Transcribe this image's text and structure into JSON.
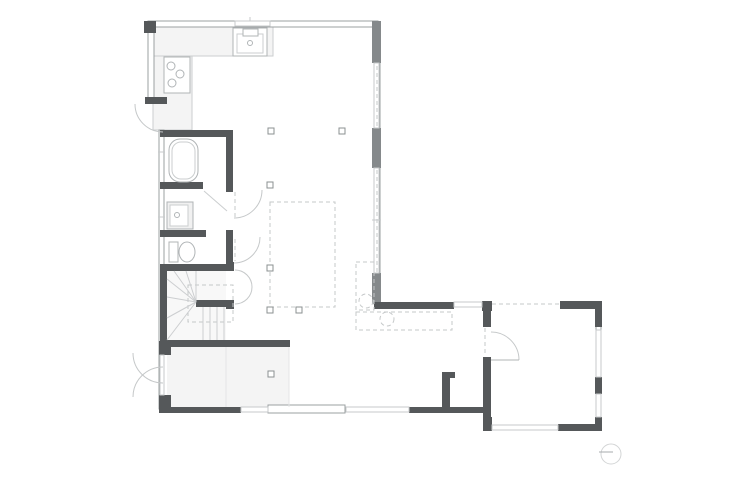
{
  "meta": {
    "width": 750,
    "height": 489,
    "background": "#ffffff",
    "drawing": "floor-plan"
  },
  "palette": {
    "wall": "#9ba0a2",
    "dark": "#55585a",
    "pier": "#85898b",
    "win": "#c7cacb",
    "fix": "#b0b4b6",
    "fixlight": "#cbcecf",
    "dash": "#c5c8c9",
    "floor": "#f4f4f4",
    "stair": "#ccced0",
    "faint": "#e4e5e6",
    "sym": "#d3d5d6",
    "symline": "#a7abad"
  },
  "shapes": [
    {
      "t": "rect",
      "n": "entry-floor",
      "x": 167,
      "y": 347,
      "w": 122,
      "h": 60,
      "f": "floor"
    },
    {
      "t": "rect",
      "n": "stair-floor",
      "x": 167,
      "y": 271,
      "w": 59,
      "h": 69,
      "f": "#f8f8f8"
    },
    {
      "t": "rect",
      "n": "kitchen-counter-left",
      "x": 153,
      "y": 27,
      "w": 39,
      "h": 103,
      "f": "floor",
      "st": "fixlight"
    },
    {
      "t": "rect",
      "n": "kitchen-counter-top",
      "x": 153,
      "y": 27,
      "w": 120,
      "h": 29,
      "f": "floor",
      "st": "fixlight"
    },
    {
      "t": "rect",
      "n": "exterior-wall-top",
      "x": 148,
      "y": 21,
      "w": 230,
      "h": 6,
      "f": "#ffffff",
      "st": "wall"
    },
    {
      "t": "rect",
      "n": "exterior-wall-left-upper",
      "x": 148,
      "y": 21,
      "w": 6,
      "h": 77,
      "f": "#ffffff",
      "st": "wall"
    },
    {
      "t": "rect",
      "n": "exterior-wall-right",
      "x": 374,
      "y": 27,
      "w": 6,
      "h": 277,
      "f": "#ffffff",
      "st": "wall"
    },
    {
      "t": "rect",
      "n": "exterior-wall-left-mid",
      "x": 159,
      "y": 130,
      "w": 5,
      "h": 217,
      "f": "#ffffff",
      "st": "wall"
    },
    {
      "t": "rect",
      "n": "exterior-wall-left-entry",
      "x": 159,
      "y": 347,
      "w": 5,
      "h": 62,
      "f": "#ffffff",
      "st": "wall"
    },
    {
      "t": "rect",
      "n": "room-wall-right",
      "x": 596,
      "y": 308,
      "w": 5,
      "h": 117,
      "f": "#ffffff",
      "st": "wall"
    },
    {
      "t": "rect",
      "n": "sliding-door-panel",
      "x": 268,
      "y": 405,
      "w": 77,
      "h": 8,
      "f": "#ffffff",
      "st": "wall"
    },
    {
      "t": "rect",
      "n": "corner-pier",
      "x": 144,
      "y": 21,
      "w": 12,
      "h": 12,
      "f": "dark"
    },
    {
      "t": "rect",
      "n": "wall-pier",
      "x": 372,
      "y": 21,
      "w": 9,
      "h": 42,
      "f": "pier"
    },
    {
      "t": "rect",
      "n": "wall-pier",
      "x": 372,
      "y": 128,
      "w": 9,
      "h": 40,
      "f": "pier"
    },
    {
      "t": "rect",
      "n": "wall-pier",
      "x": 372,
      "y": 273,
      "w": 9,
      "h": 31,
      "f": "pier"
    },
    {
      "t": "rect",
      "n": "kitchen-door-cap",
      "x": 145,
      "y": 97,
      "w": 22,
      "h": 7,
      "f": "dark"
    },
    {
      "t": "rect",
      "n": "entry-pier-top",
      "x": 159,
      "y": 341,
      "w": 12,
      "h": 14,
      "f": "dark"
    },
    {
      "t": "rect",
      "n": "entry-pier-bottom",
      "x": 159,
      "y": 395,
      "w": 12,
      "h": 16,
      "f": "dark"
    },
    {
      "t": "rect",
      "n": "wing-wall-top",
      "x": 374,
      "y": 302,
      "w": 80,
      "h": 7,
      "f": "dark"
    },
    {
      "t": "rect",
      "n": "wall-pier",
      "x": 482,
      "y": 301,
      "w": 10,
      "h": 10,
      "f": "dark"
    },
    {
      "t": "rect",
      "n": "room-wall-left-upper",
      "x": 483,
      "y": 309,
      "w": 8,
      "h": 18,
      "f": "dark"
    },
    {
      "t": "rect",
      "n": "room-wall-left-lower",
      "x": 483,
      "y": 357,
      "w": 8,
      "h": 74,
      "f": "dark"
    },
    {
      "t": "rect",
      "n": "room-wall-top",
      "x": 560,
      "y": 301,
      "w": 42,
      "h": 8,
      "f": "dark"
    },
    {
      "t": "rect",
      "n": "room-pier-ne",
      "x": 595,
      "y": 301,
      "w": 7,
      "h": 26,
      "f": "dark"
    },
    {
      "t": "rect",
      "n": "room-pier-east",
      "x": 595,
      "y": 377,
      "w": 7,
      "h": 17,
      "f": "dark"
    },
    {
      "t": "rect",
      "n": "room-pier-se",
      "x": 595,
      "y": 417,
      "w": 7,
      "h": 14,
      "f": "dark"
    },
    {
      "t": "rect",
      "n": "room-wall-bottom",
      "x": 558,
      "y": 424,
      "w": 44,
      "h": 7,
      "f": "dark"
    },
    {
      "t": "rect",
      "n": "room-pier-sw",
      "x": 483,
      "y": 417,
      "w": 9,
      "h": 14,
      "f": "dark"
    },
    {
      "t": "rect",
      "n": "wall-bottom-a",
      "x": 159,
      "y": 407,
      "w": 82,
      "h": 6,
      "f": "dark"
    },
    {
      "t": "rect",
      "n": "wall-bottom-b",
      "x": 409,
      "y": 407,
      "w": 77,
      "h": 6,
      "f": "dark"
    },
    {
      "t": "rect",
      "n": "wall-stub",
      "x": 442,
      "y": 372,
      "w": 8,
      "h": 41,
      "f": "dark"
    },
    {
      "t": "rect",
      "n": "wall-stub-notch",
      "x": 450,
      "y": 372,
      "w": 5,
      "h": 6,
      "f": "dark"
    },
    {
      "t": "rect",
      "n": "bath-wall-top",
      "x": 160,
      "y": 130,
      "w": 73,
      "h": 7,
      "f": "dark"
    },
    {
      "t": "rect",
      "n": "bath-wall-right",
      "x": 226,
      "y": 130,
      "w": 7,
      "h": 62,
      "f": "dark"
    },
    {
      "t": "rect",
      "n": "bath-wall-low",
      "x": 160,
      "y": 182,
      "w": 43,
      "h": 7,
      "f": "dark"
    },
    {
      "t": "rect",
      "n": "washroom-toilet-wall",
      "x": 160,
      "y": 230,
      "w": 46,
      "h": 7,
      "f": "dark"
    },
    {
      "t": "rect",
      "n": "toilet-wall-right",
      "x": 226,
      "y": 230,
      "w": 7,
      "h": 40,
      "f": "dark"
    },
    {
      "t": "rect",
      "n": "stair-wall-top",
      "x": 160,
      "y": 264,
      "w": 73,
      "h": 7,
      "f": "dark"
    },
    {
      "t": "rect",
      "n": "stair-wall-left",
      "x": 160,
      "y": 264,
      "w": 7,
      "h": 83,
      "f": "dark"
    },
    {
      "t": "rect",
      "n": "closet-pier-top",
      "x": 226,
      "y": 262,
      "w": 8,
      "h": 9,
      "f": "dark"
    },
    {
      "t": "rect",
      "n": "closet-pier-bottom",
      "x": 226,
      "y": 300,
      "w": 8,
      "h": 9,
      "f": "dark"
    },
    {
      "t": "rect",
      "n": "stair-landing-wall",
      "x": 196,
      "y": 300,
      "w": 37,
      "h": 7,
      "f": "dark"
    },
    {
      "t": "rect",
      "n": "stair-wall-bottom",
      "x": 160,
      "y": 340,
      "w": 130,
      "h": 7,
      "f": "dark"
    },
    {
      "t": "rect",
      "n": "window",
      "x": 235,
      "y": 21,
      "w": 35,
      "h": 5,
      "f": "#ffffff",
      "st": "win"
    },
    {
      "t": "rect",
      "n": "window",
      "x": 374,
      "y": 63,
      "w": 5,
      "h": 65,
      "f": "#ffffff",
      "st": "win"
    },
    {
      "t": "rect",
      "n": "window",
      "x": 374,
      "y": 168,
      "w": 5,
      "h": 105,
      "f": "#ffffff",
      "st": "win"
    },
    {
      "t": "rect",
      "n": "window",
      "x": 241,
      "y": 407,
      "w": 27,
      "h": 5,
      "f": "#ffffff",
      "st": "win"
    },
    {
      "t": "rect",
      "n": "window",
      "x": 346,
      "y": 407,
      "w": 63,
      "h": 5,
      "f": "#ffffff",
      "st": "win"
    },
    {
      "t": "rect",
      "n": "window",
      "x": 454,
      "y": 302,
      "w": 28,
      "h": 5,
      "f": "#ffffff",
      "st": "win"
    },
    {
      "t": "rect",
      "n": "window",
      "x": 596,
      "y": 330,
      "w": 5,
      "h": 47,
      "f": "#ffffff",
      "st": "win"
    },
    {
      "t": "rect",
      "n": "window",
      "x": 596,
      "y": 394,
      "w": 5,
      "h": 23,
      "f": "#ffffff",
      "st": "win"
    },
    {
      "t": "rect",
      "n": "window",
      "x": 492,
      "y": 425,
      "w": 66,
      "h": 5,
      "f": "#ffffff",
      "st": "win"
    },
    {
      "t": "rect",
      "n": "window",
      "x": 160,
      "y": 355,
      "w": 4,
      "h": 40,
      "f": "#ffffff",
      "st": "win"
    },
    {
      "t": "line",
      "n": "window-glazing-dash",
      "x1": 377,
      "y1": 66,
      "x2": 377,
      "y2": 127,
      "st": "dash",
      "d": true
    },
    {
      "t": "line",
      "n": "window-glazing-dash",
      "x1": 377,
      "y1": 170,
      "x2": 377,
      "y2": 272,
      "st": "dash",
      "d": true
    },
    {
      "t": "line",
      "n": "room-top-opening-dash",
      "x1": 492,
      "y1": 304,
      "x2": 559,
      "y2": 304,
      "st": "dash",
      "d": true
    },
    {
      "t": "line",
      "n": "room-door-opening-dash",
      "x1": 485,
      "y1": 328,
      "x2": 485,
      "y2": 356,
      "st": "dash",
      "d": true
    },
    {
      "t": "line",
      "n": "washroom-door-dash",
      "x1": 235,
      "y1": 192,
      "x2": 235,
      "y2": 217,
      "st": "dash",
      "d": true
    },
    {
      "t": "line",
      "n": "toilet-door-dash",
      "x1": 235,
      "y1": 239,
      "x2": 235,
      "y2": 261,
      "st": "dash",
      "d": true
    },
    {
      "t": "rect",
      "n": "void-outline-dashed",
      "x": 270,
      "y": 202,
      "w": 65,
      "h": 105,
      "st": "dash",
      "d": true
    },
    {
      "t": "rect",
      "n": "dashed-counter-side",
      "x": 356,
      "y": 262,
      "w": 18,
      "h": 48,
      "st": "dash",
      "d": true
    },
    {
      "t": "rect",
      "n": "dashed-counter-bottom",
      "x": 356,
      "y": 312,
      "w": 96,
      "h": 18,
      "st": "dash",
      "d": true
    },
    {
      "t": "rect",
      "n": "stair-overhead-dashed",
      "x": 188,
      "y": 285,
      "w": 45,
      "h": 37,
      "st": "dash",
      "d": true
    },
    {
      "t": "circle",
      "n": "dashed-fixture-circle",
      "cx": 366,
      "cy": 301,
      "r": 7,
      "st": "dash",
      "d": true
    },
    {
      "t": "circle",
      "n": "dashed-fixture-circle",
      "cx": 387,
      "cy": 319,
      "r": 7,
      "st": "dash",
      "d": true
    },
    {
      "t": "sq",
      "n": "column-marker",
      "cx": 271,
      "cy": 131,
      "s": 6
    },
    {
      "t": "sq",
      "n": "column-marker",
      "cx": 342,
      "cy": 131,
      "s": 6
    },
    {
      "t": "sq",
      "n": "column-marker",
      "cx": 270,
      "cy": 185,
      "s": 6
    },
    {
      "t": "sq",
      "n": "column-marker",
      "cx": 270,
      "cy": 268,
      "s": 6
    },
    {
      "t": "sq",
      "n": "column-marker",
      "cx": 270,
      "cy": 310,
      "s": 6
    },
    {
      "t": "sq",
      "n": "column-marker",
      "cx": 299,
      "cy": 310,
      "s": 6
    },
    {
      "t": "sq",
      "n": "column-marker",
      "cx": 271,
      "cy": 374,
      "s": 6
    },
    {
      "t": "rect",
      "n": "cooktop",
      "x": 164,
      "y": 57,
      "w": 26,
      "h": 36,
      "f": "#ffffff",
      "st": "fix"
    },
    {
      "t": "circle",
      "n": "burner",
      "cx": 171,
      "cy": 66,
      "r": 4,
      "st": "fix"
    },
    {
      "t": "circle",
      "n": "burner",
      "cx": 180,
      "cy": 74,
      "r": 4,
      "st": "fix"
    },
    {
      "t": "circle",
      "n": "burner",
      "cx": 172,
      "cy": 83,
      "r": 4,
      "st": "fix"
    },
    {
      "t": "rect",
      "n": "kitchen-sink",
      "x": 233,
      "y": 28,
      "w": 34,
      "h": 28,
      "f": "#ffffff",
      "st": "fix"
    },
    {
      "t": "rect",
      "n": "kitchen-sink-basin",
      "x": 237,
      "y": 34,
      "w": 26,
      "h": 19,
      "st": "fixlight"
    },
    {
      "t": "rect",
      "n": "kitchen-faucet",
      "x": 243,
      "y": 29,
      "w": 15,
      "h": 7,
      "f": "#ffffff",
      "st": "fix"
    },
    {
      "t": "circle",
      "n": "sink-drain",
      "cx": 250,
      "cy": 43,
      "r": 2.5,
      "st": "fix"
    },
    {
      "t": "rect",
      "n": "bathtub",
      "x": 169,
      "y": 139,
      "w": 29,
      "h": 43,
      "rx": 11,
      "f": "#ffffff",
      "st": "fix"
    },
    {
      "t": "rect",
      "n": "bathtub-inner",
      "x": 172,
      "y": 142,
      "w": 23,
      "h": 37,
      "rx": 9,
      "st": "fixlight"
    },
    {
      "t": "rect",
      "n": "washbasin",
      "x": 167,
      "y": 202,
      "w": 26,
      "h": 27,
      "f": "#f1f1f1",
      "st": "fix"
    },
    {
      "t": "rect",
      "n": "washbasin-bowl",
      "x": 170,
      "y": 205,
      "w": 18,
      "h": 21,
      "f": "#ffffff",
      "st": "fixlight"
    },
    {
      "t": "circle",
      "n": "washbasin-drain",
      "cx": 177,
      "cy": 215,
      "r": 2.5,
      "st": "fix"
    },
    {
      "t": "rect",
      "n": "toilet-tank",
      "x": 169,
      "y": 242,
      "w": 9,
      "h": 20,
      "f": "#ffffff",
      "st": "fix"
    },
    {
      "t": "ellipse",
      "n": "toilet-bowl",
      "cx": 187,
      "cy": 252,
      "rx": 8,
      "ry": 10,
      "f": "#ffffff",
      "st": "fix"
    },
    {
      "t": "line",
      "n": "stair-winder",
      "x1": 196,
      "y1": 302,
      "x2": 167,
      "y2": 340,
      "st": "stair"
    },
    {
      "t": "line",
      "n": "stair-winder",
      "x1": 196,
      "y1": 302,
      "x2": 167,
      "y2": 318,
      "st": "stair"
    },
    {
      "t": "line",
      "n": "stair-winder",
      "x1": 196,
      "y1": 302,
      "x2": 167,
      "y2": 297,
      "st": "stair"
    },
    {
      "t": "line",
      "n": "stair-winder",
      "x1": 196,
      "y1": 302,
      "x2": 167,
      "y2": 279,
      "st": "stair"
    },
    {
      "t": "line",
      "n": "stair-winder",
      "x1": 196,
      "y1": 302,
      "x2": 174,
      "y2": 271,
      "st": "stair"
    },
    {
      "t": "line",
      "n": "stair-winder",
      "x1": 196,
      "y1": 302,
      "x2": 186,
      "y2": 271,
      "st": "stair"
    },
    {
      "t": "line",
      "n": "stair-winder",
      "x1": 196,
      "y1": 302,
      "x2": 196,
      "y2": 271,
      "st": "stair"
    },
    {
      "t": "line",
      "n": "stair-tread",
      "x1": 203,
      "y1": 307,
      "x2": 203,
      "y2": 340,
      "st": "stair"
    },
    {
      "t": "line",
      "n": "stair-tread",
      "x1": 210,
      "y1": 307,
      "x2": 210,
      "y2": 340,
      "st": "stair"
    },
    {
      "t": "line",
      "n": "stair-tread",
      "x1": 217,
      "y1": 307,
      "x2": 217,
      "y2": 340,
      "st": "stair"
    },
    {
      "t": "line",
      "n": "stair-tread",
      "x1": 224,
      "y1": 307,
      "x2": 224,
      "y2": 340,
      "st": "stair"
    },
    {
      "t": "path",
      "n": "kitchen-door-arc",
      "p": "M163,132 A28,28 0 0 1 135,104",
      "st": "dash"
    },
    {
      "t": "path",
      "n": "entry-door-arc",
      "p": "M163,383 A30,30 0 0 1 133,353",
      "st": "dash"
    },
    {
      "t": "path",
      "n": "entry-door-arc",
      "p": "M163,367 A30,30 0 0 0 133,397",
      "st": "dash"
    },
    {
      "t": "path",
      "n": "washroom-door-arc",
      "p": "M234,218 A28,28 0 0 0 262,190",
      "st": "dash"
    },
    {
      "t": "path",
      "n": "toilet-door-arc",
      "p": "M234,263 A26,26 0 0 0 260,237",
      "st": "dash"
    },
    {
      "t": "path",
      "n": "closet-door-arc",
      "p": "M235,270 A17,17 0 0 1 252,287",
      "st": "dash"
    },
    {
      "t": "path",
      "n": "closet-door-arc",
      "p": "M235,304 A17,17 0 0 0 252,287",
      "st": "dash"
    },
    {
      "t": "path",
      "n": "room-door-arc",
      "p": "M491,332 A28,28 0 0 1 519,360",
      "st": "dash"
    },
    {
      "t": "line",
      "n": "room-door-leaf",
      "x1": 491,
      "y1": 360,
      "x2": 519,
      "y2": 360,
      "st": "fix"
    },
    {
      "t": "line",
      "n": "bath-door-line",
      "x1": 204,
      "y1": 191,
      "x2": 227,
      "y2": 211,
      "st": "fixlight"
    },
    {
      "t": "line",
      "n": "entry-floor-edge",
      "x1": 226,
      "y1": 347,
      "x2": 226,
      "y2": 407,
      "st": "faint"
    },
    {
      "t": "line",
      "n": "entry-floor-edge",
      "x1": 289,
      "y1": 347,
      "x2": 289,
      "y2": 407,
      "st": "faint"
    },
    {
      "t": "line",
      "n": "window-tick",
      "x1": 158,
      "y1": 152,
      "x2": 165,
      "y2": 152,
      "st": "win"
    },
    {
      "t": "line",
      "n": "window-tick",
      "x1": 158,
      "y1": 217,
      "x2": 165,
      "y2": 217,
      "st": "win"
    },
    {
      "t": "line",
      "n": "window-tick",
      "x1": 372,
      "y1": 220,
      "x2": 381,
      "y2": 220,
      "st": "win"
    },
    {
      "t": "line",
      "n": "window-tick",
      "x1": 250,
      "y1": 17,
      "x2": 250,
      "y2": 21,
      "st": "win"
    },
    {
      "t": "circle",
      "n": "north-symbol",
      "cx": 611,
      "cy": 454,
      "r": 10,
      "st": "sym"
    },
    {
      "t": "line",
      "n": "north-symbol-line",
      "x1": 599,
      "y1": 452,
      "x2": 613,
      "y2": 452,
      "st": "symline"
    }
  ]
}
